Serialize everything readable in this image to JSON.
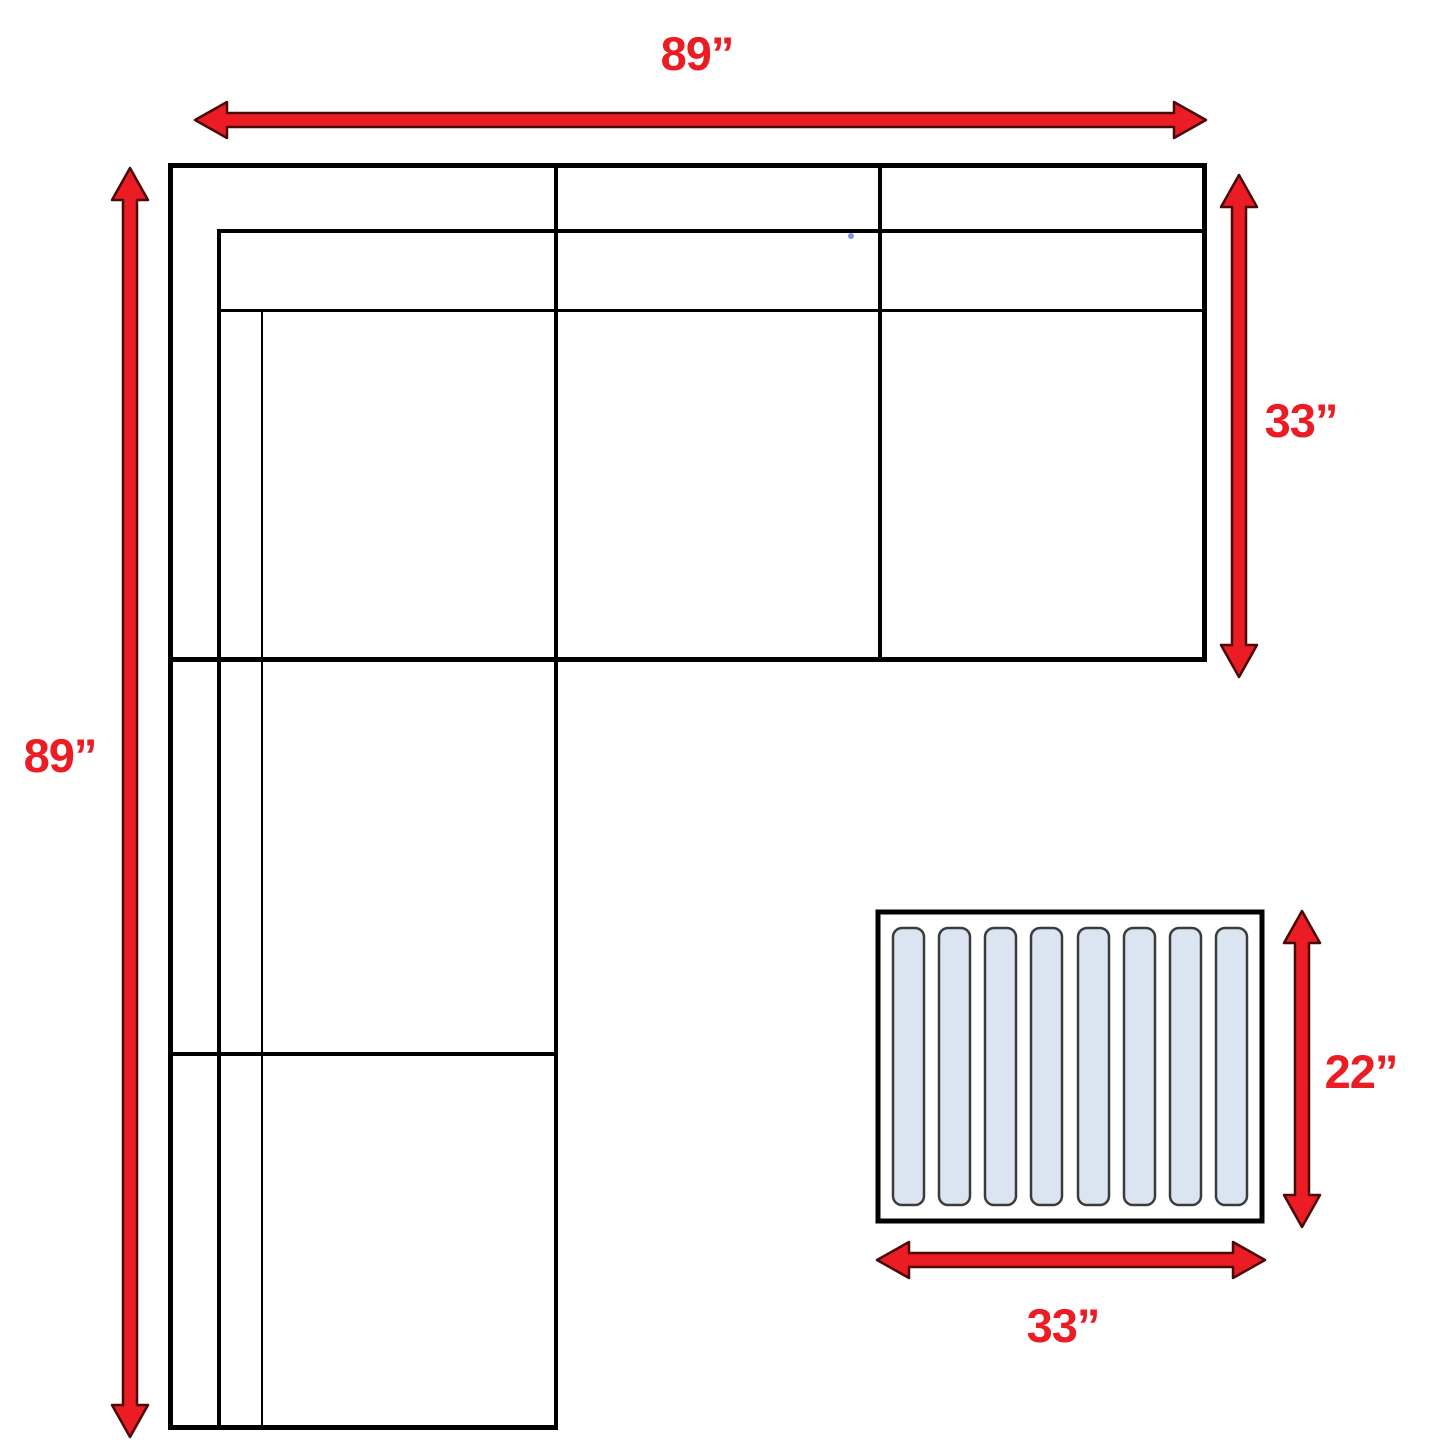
{
  "diagram": {
    "sofa": {
      "width_label": "89”",
      "length_label": "89”",
      "depth_label": "33”"
    },
    "ottoman": {
      "width_label": "33”",
      "depth_label": "22”",
      "slat_count": 8
    },
    "colors": {
      "arrow_red": "#ec1c24",
      "arrow_outline": "#4a0808",
      "line_black": "#000000",
      "slat_fill": "#dbe5f1",
      "slat_outline": "#3b3b3b",
      "background": "#ffffff"
    }
  }
}
